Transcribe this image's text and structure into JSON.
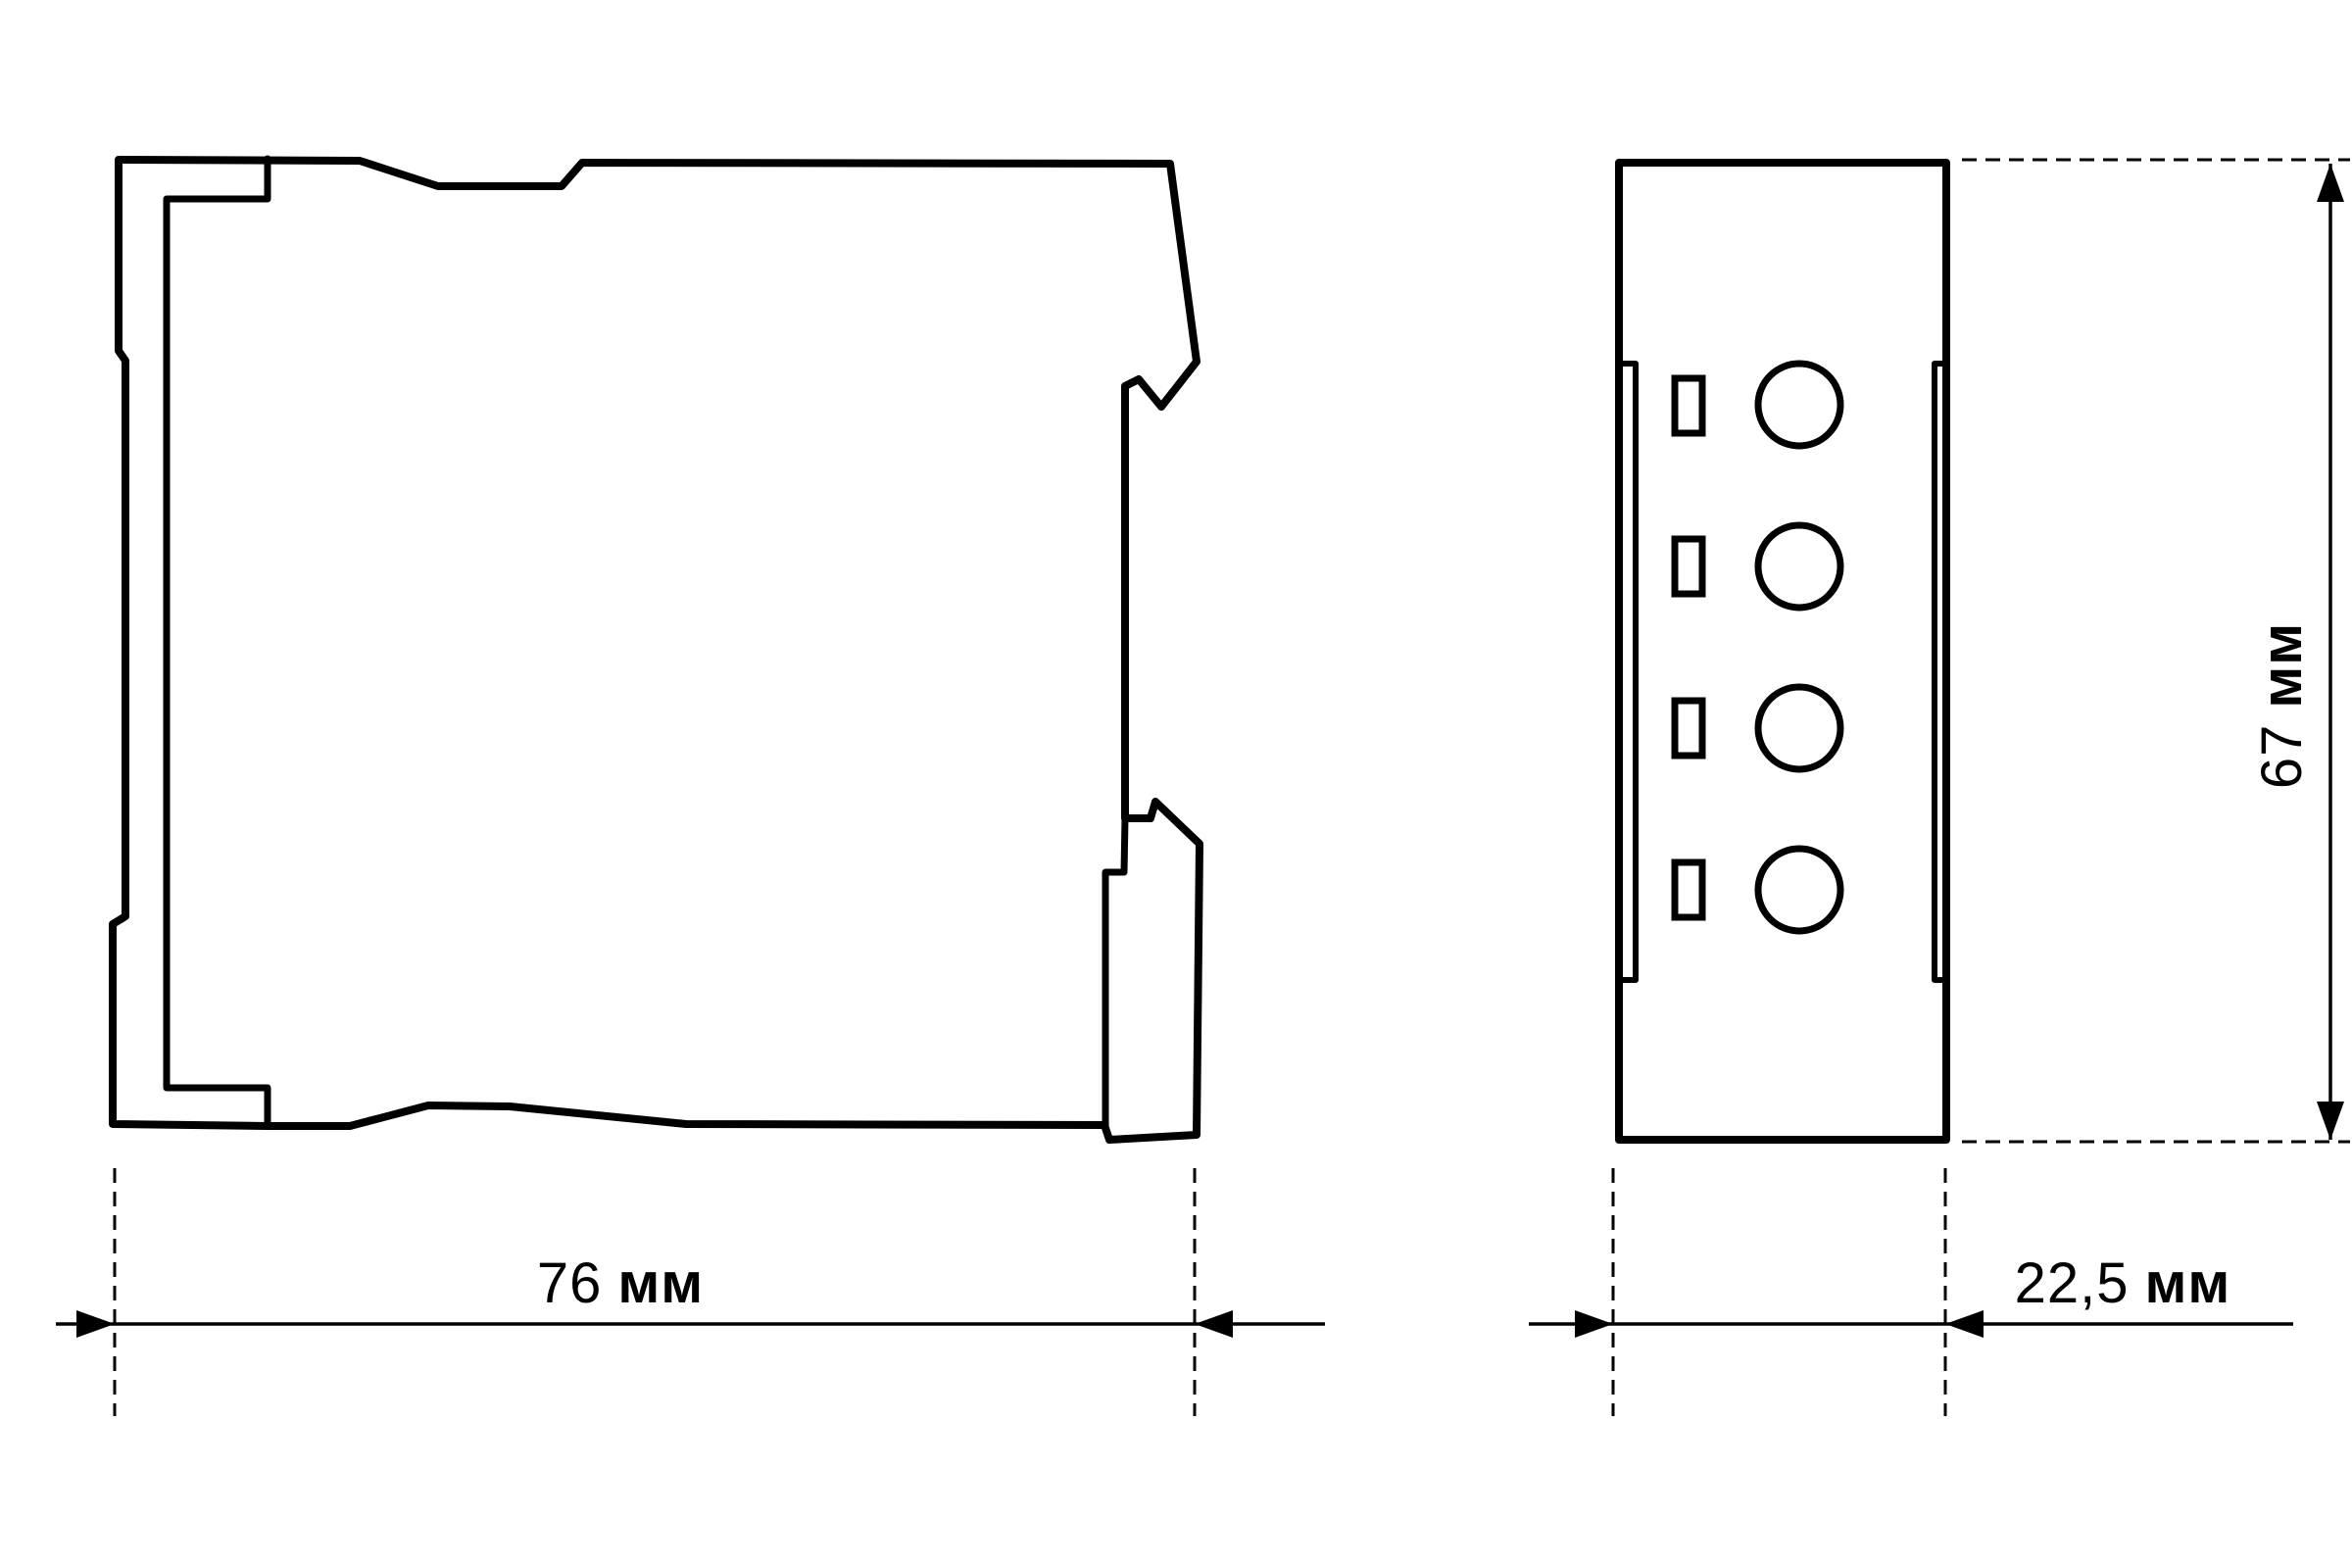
{
  "drawing_title": "DIN-rail module dimensional drawing",
  "colors": {
    "line": "#000000",
    "background": "#ffffff"
  },
  "dimensions": {
    "width": {
      "value": "76",
      "unit": "мм"
    },
    "depth": {
      "value": "22,5",
      "unit": "мм"
    },
    "height": {
      "value": "67",
      "unit": "мм"
    }
  },
  "front_view": {
    "terminal_screws": 4,
    "terminal_slots": 4
  }
}
